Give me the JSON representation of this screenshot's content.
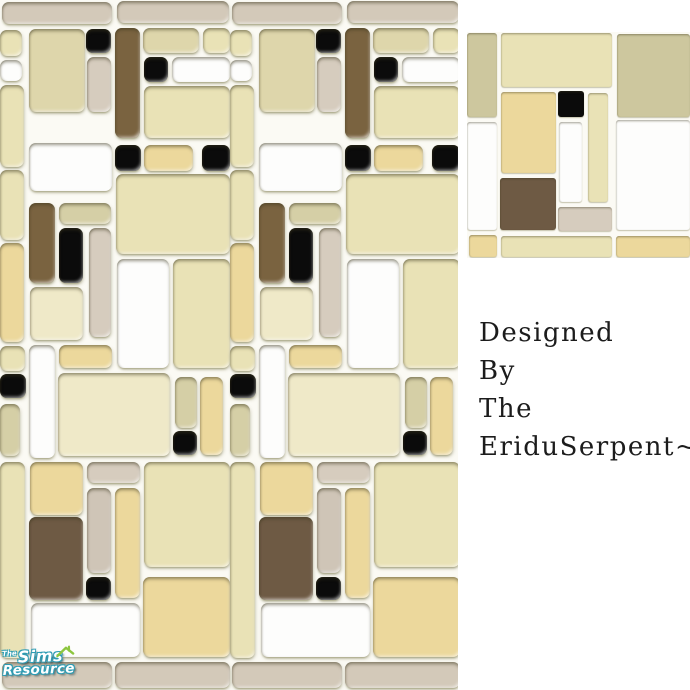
{
  "canvas": {
    "width": 690,
    "height": 690,
    "background": "#ffffff"
  },
  "palette": {
    "tan": "#d3c9b9",
    "cream": "#e9e2b6",
    "cream2": "#ded6ab",
    "creamL": "#efe9c8",
    "gold": "#ecd89c",
    "olive": "#cdc79e",
    "khaki": "#d5cfa6",
    "beige": "#d6ccbe",
    "taupe": "#cfc5b7",
    "brown": "#6e5a44",
    "brown2": "#7a6340",
    "white": "#fdfdfc",
    "black": "#0b0b0b",
    "grout": "#fbfaf4"
  },
  "main_panel": {
    "column_width": 230,
    "repeats": 2,
    "tiles": [
      {
        "x": 2,
        "y": 2,
        "w": 110,
        "h": 22,
        "c": "tan"
      },
      {
        "x": 117,
        "y": 1,
        "w": 112,
        "h": 22,
        "c": "tan"
      },
      {
        "x": 0,
        "y": 30,
        "w": 22,
        "h": 26,
        "c": "cream"
      },
      {
        "x": 0,
        "y": 60,
        "w": 22,
        "h": 21,
        "c": "white"
      },
      {
        "x": 0,
        "y": 85,
        "w": 24,
        "h": 82,
        "c": "cream"
      },
      {
        "x": 29,
        "y": 29,
        "w": 56,
        "h": 83,
        "c": "cream2"
      },
      {
        "x": 86,
        "y": 29,
        "w": 25,
        "h": 24,
        "c": "black"
      },
      {
        "x": 87,
        "y": 57,
        "w": 24,
        "h": 55,
        "c": "beige"
      },
      {
        "x": 115,
        "y": 28,
        "w": 25,
        "h": 110,
        "c": "brown2"
      },
      {
        "x": 143,
        "y": 28,
        "w": 56,
        "h": 25,
        "c": "cream2"
      },
      {
        "x": 203,
        "y": 28,
        "w": 27,
        "h": 25,
        "c": "cream"
      },
      {
        "x": 144,
        "y": 57,
        "w": 24,
        "h": 25,
        "c": "black"
      },
      {
        "x": 172,
        "y": 57,
        "w": 58,
        "h": 25,
        "c": "white"
      },
      {
        "x": 144,
        "y": 86,
        "w": 86,
        "h": 52,
        "c": "cream"
      },
      {
        "x": 115,
        "y": 145,
        "w": 26,
        "h": 26,
        "c": "black"
      },
      {
        "x": 144,
        "y": 145,
        "w": 49,
        "h": 26,
        "c": "gold"
      },
      {
        "x": 202,
        "y": 145,
        "w": 28,
        "h": 26,
        "c": "black"
      },
      {
        "x": 29,
        "y": 143,
        "w": 83,
        "h": 48,
        "c": "white"
      },
      {
        "x": 116,
        "y": 174,
        "w": 114,
        "h": 80,
        "c": "cream"
      },
      {
        "x": 29,
        "y": 203,
        "w": 26,
        "h": 80,
        "c": "brown2"
      },
      {
        "x": 59,
        "y": 203,
        "w": 52,
        "h": 21,
        "c": "khaki"
      },
      {
        "x": 0,
        "y": 170,
        "w": 24,
        "h": 70,
        "c": "cream"
      },
      {
        "x": 59,
        "y": 228,
        "w": 24,
        "h": 55,
        "c": "black"
      },
      {
        "x": 89,
        "y": 228,
        "w": 22,
        "h": 109,
        "c": "beige"
      },
      {
        "x": 0,
        "y": 243,
        "w": 24,
        "h": 99,
        "c": "gold"
      },
      {
        "x": 117,
        "y": 259,
        "w": 52,
        "h": 109,
        "c": "white"
      },
      {
        "x": 173,
        "y": 259,
        "w": 57,
        "h": 109,
        "c": "cream"
      },
      {
        "x": 30,
        "y": 287,
        "w": 53,
        "h": 53,
        "c": "creamL"
      },
      {
        "x": 0,
        "y": 346,
        "w": 25,
        "h": 25,
        "c": "cream"
      },
      {
        "x": 29,
        "y": 345,
        "w": 26,
        "h": 113,
        "c": "white"
      },
      {
        "x": 59,
        "y": 345,
        "w": 53,
        "h": 23,
        "c": "gold"
      },
      {
        "x": 58,
        "y": 373,
        "w": 112,
        "h": 83,
        "c": "creamL"
      },
      {
        "x": 0,
        "y": 374,
        "w": 26,
        "h": 24,
        "c": "black"
      },
      {
        "x": 0,
        "y": 404,
        "w": 20,
        "h": 52,
        "c": "khaki"
      },
      {
        "x": 175,
        "y": 377,
        "w": 22,
        "h": 51,
        "c": "khaki"
      },
      {
        "x": 200,
        "y": 377,
        "w": 23,
        "h": 78,
        "c": "gold"
      },
      {
        "x": 173,
        "y": 431,
        "w": 24,
        "h": 24,
        "c": "black"
      },
      {
        "x": 0,
        "y": 462,
        "w": 25,
        "h": 196,
        "c": "cream"
      },
      {
        "x": 30,
        "y": 462,
        "w": 53,
        "h": 53,
        "c": "gold"
      },
      {
        "x": 29,
        "y": 517,
        "w": 54,
        "h": 83,
        "c": "brown"
      },
      {
        "x": 87,
        "y": 462,
        "w": 53,
        "h": 21,
        "c": "beige"
      },
      {
        "x": 87,
        "y": 488,
        "w": 24,
        "h": 85,
        "c": "taupe"
      },
      {
        "x": 115,
        "y": 488,
        "w": 25,
        "h": 110,
        "c": "gold"
      },
      {
        "x": 86,
        "y": 577,
        "w": 25,
        "h": 23,
        "c": "black"
      },
      {
        "x": 144,
        "y": 462,
        "w": 86,
        "h": 105,
        "c": "cream"
      },
      {
        "x": 143,
        "y": 577,
        "w": 87,
        "h": 80,
        "c": "gold"
      },
      {
        "x": 31,
        "y": 603,
        "w": 109,
        "h": 54,
        "c": "white"
      },
      {
        "x": 2,
        "y": 662,
        "w": 110,
        "h": 26,
        "c": "tan"
      },
      {
        "x": 115,
        "y": 662,
        "w": 115,
        "h": 26,
        "c": "tan"
      }
    ]
  },
  "preview_panel": {
    "column_width": 0,
    "repeats": 1,
    "tiles": [
      {
        "x": 0,
        "y": 1,
        "w": 30,
        "h": 84,
        "c": "olive"
      },
      {
        "x": 0,
        "y": 90,
        "w": 30,
        "h": 108,
        "c": "white"
      },
      {
        "x": 34,
        "y": 1,
        "w": 111,
        "h": 54,
        "c": "cream"
      },
      {
        "x": 150,
        "y": 2,
        "w": 73,
        "h": 83,
        "c": "olive"
      },
      {
        "x": 34,
        "y": 60,
        "w": 55,
        "h": 81,
        "c": "gold"
      },
      {
        "x": 91,
        "y": 59,
        "w": 26,
        "h": 26,
        "c": "black"
      },
      {
        "x": 92,
        "y": 90,
        "w": 23,
        "h": 80,
        "c": "white"
      },
      {
        "x": 121,
        "y": 61,
        "w": 20,
        "h": 109,
        "c": "cream"
      },
      {
        "x": 149,
        "y": 88,
        "w": 74,
        "h": 110,
        "c": "white"
      },
      {
        "x": 33,
        "y": 146,
        "w": 56,
        "h": 52,
        "c": "brown"
      },
      {
        "x": 91,
        "y": 175,
        "w": 54,
        "h": 24,
        "c": "beige"
      },
      {
        "x": 2,
        "y": 203,
        "w": 28,
        "h": 22,
        "c": "gold"
      },
      {
        "x": 34,
        "y": 204,
        "w": 111,
        "h": 21,
        "c": "cream"
      },
      {
        "x": 149,
        "y": 204,
        "w": 74,
        "h": 21,
        "c": "gold"
      }
    ]
  },
  "credit": {
    "lines": [
      "Designed",
      "By",
      "The",
      "EriduSerpent~"
    ],
    "color": "#1c1c1c"
  },
  "logo": {
    "the_label": "The",
    "sims_label": "Sims",
    "resource_label": "Resource",
    "outline_color": "#2d9cb4",
    "fill_color": "#ffffff",
    "roof_color": "#8dc63f"
  }
}
